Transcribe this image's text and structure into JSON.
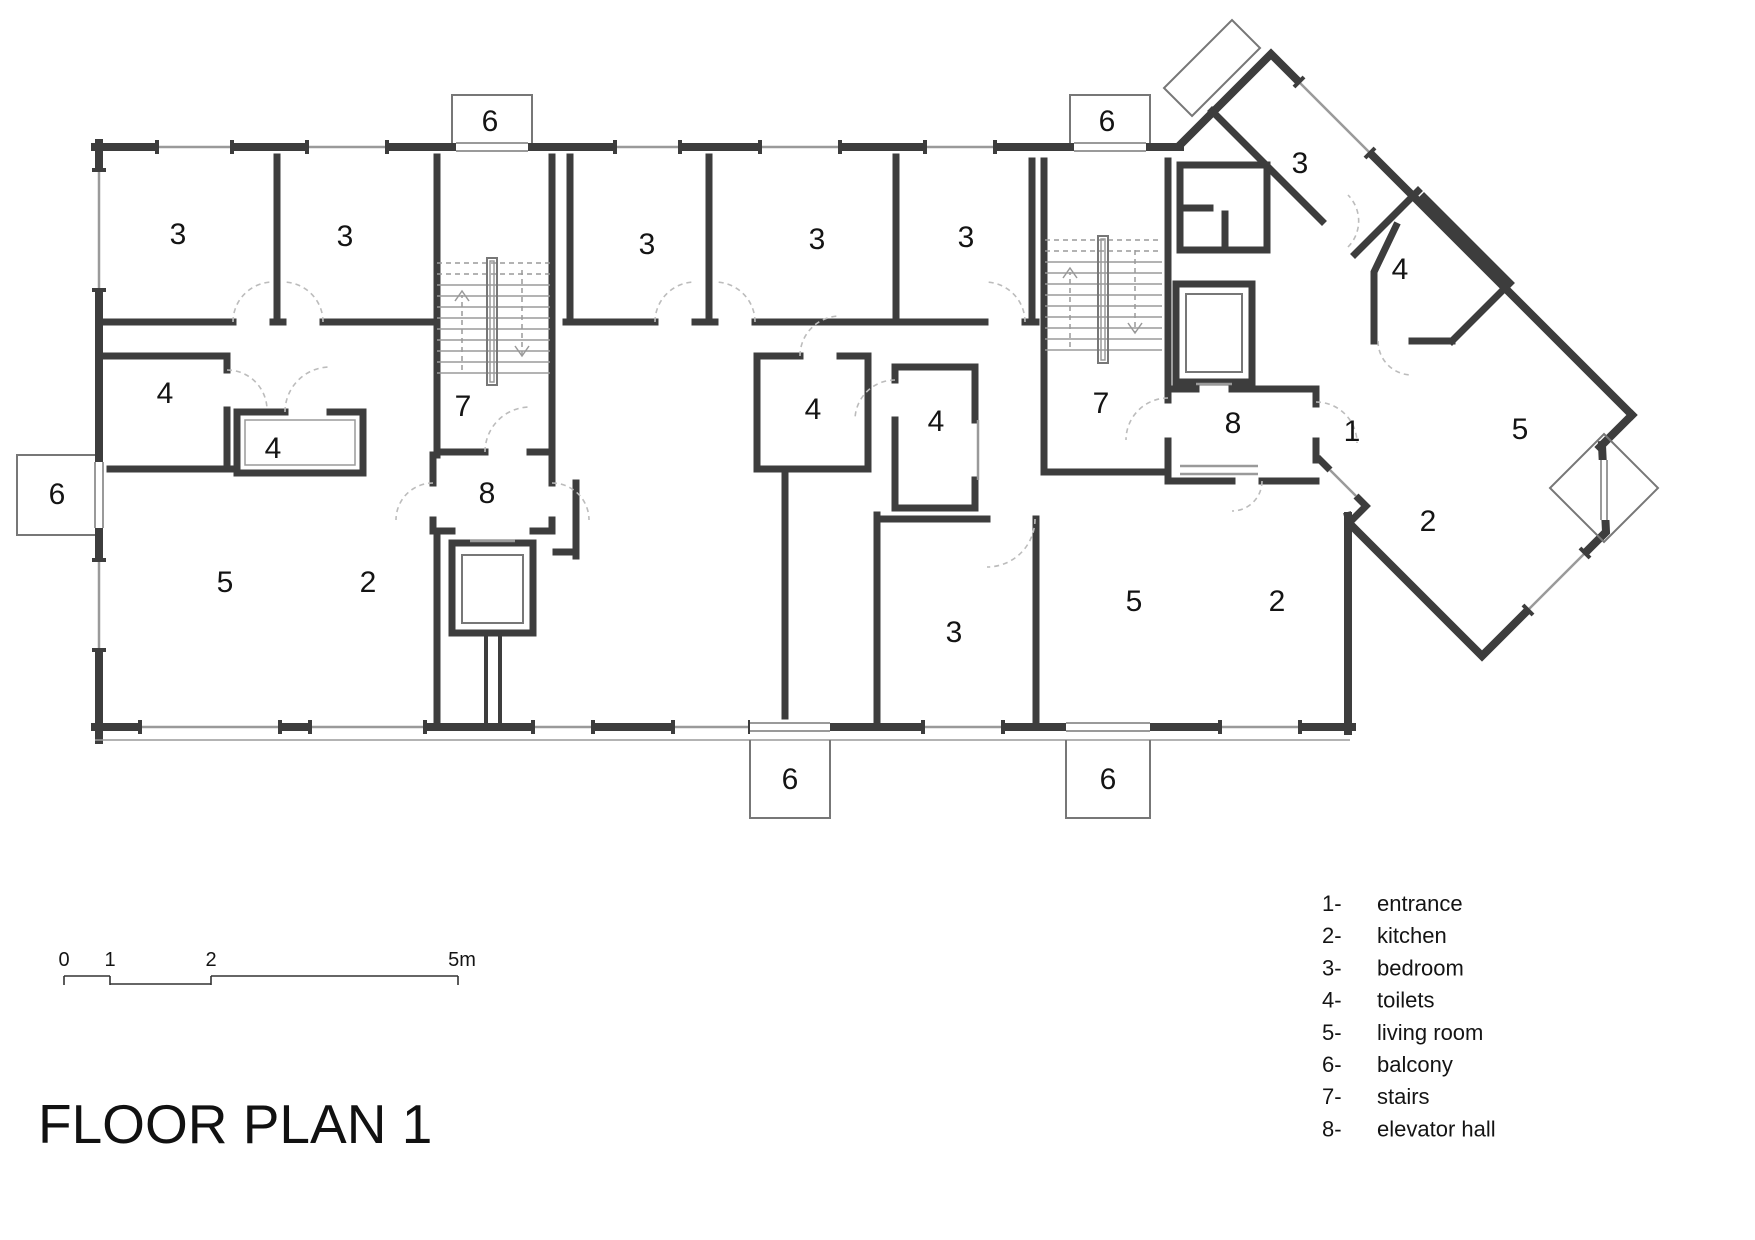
{
  "title": "FLOOR PLAN 1",
  "legend": {
    "items": [
      {
        "num": "1-",
        "label": "entrance"
      },
      {
        "num": "2-",
        "label": "kitchen"
      },
      {
        "num": "3-",
        "label": "bedroom"
      },
      {
        "num": "4-",
        "label": "toilets"
      },
      {
        "num": "5-",
        "label": "living room"
      },
      {
        "num": "6-",
        "label": "balcony"
      },
      {
        "num": "7-",
        "label": "stairs"
      },
      {
        "num": "8-",
        "label": "elevator hall"
      }
    ]
  },
  "scale_bar": {
    "labels": [
      {
        "text": "0",
        "x": 64
      },
      {
        "text": "1",
        "x": 110
      },
      {
        "text": "2",
        "x": 211
      },
      {
        "text": "5m",
        "x": 462
      }
    ]
  },
  "plan": {
    "room_labels": [
      {
        "t": "3",
        "x": 178,
        "y": 233
      },
      {
        "t": "3",
        "x": 345,
        "y": 235
      },
      {
        "t": "3",
        "x": 647,
        "y": 243
      },
      {
        "t": "3",
        "x": 817,
        "y": 238
      },
      {
        "t": "3",
        "x": 966,
        "y": 236
      },
      {
        "t": "3",
        "x": 1300,
        "y": 162
      },
      {
        "t": "3",
        "x": 954,
        "y": 631
      },
      {
        "t": "4",
        "x": 165,
        "y": 392
      },
      {
        "t": "4",
        "x": 273,
        "y": 447
      },
      {
        "t": "4",
        "x": 813,
        "y": 408
      },
      {
        "t": "4",
        "x": 936,
        "y": 420
      },
      {
        "t": "4",
        "x": 1400,
        "y": 268
      },
      {
        "t": "5",
        "x": 225,
        "y": 581
      },
      {
        "t": "5",
        "x": 1134,
        "y": 600
      },
      {
        "t": "5",
        "x": 1520,
        "y": 428
      },
      {
        "t": "2",
        "x": 368,
        "y": 581
      },
      {
        "t": "2",
        "x": 1277,
        "y": 600
      },
      {
        "t": "2",
        "x": 1428,
        "y": 520
      },
      {
        "t": "1",
        "x": 1352,
        "y": 430
      },
      {
        "t": "7",
        "x": 463,
        "y": 405
      },
      {
        "t": "7",
        "x": 1101,
        "y": 402
      },
      {
        "t": "8",
        "x": 487,
        "y": 492
      },
      {
        "t": "8",
        "x": 1233,
        "y": 422
      },
      {
        "t": "6",
        "x": 490,
        "y": 120
      },
      {
        "t": "6",
        "x": 1107,
        "y": 120
      },
      {
        "t": "6",
        "x": 57,
        "y": 493
      },
      {
        "t": "6",
        "x": 790,
        "y": 778
      },
      {
        "t": "6",
        "x": 1108,
        "y": 778
      }
    ]
  }
}
